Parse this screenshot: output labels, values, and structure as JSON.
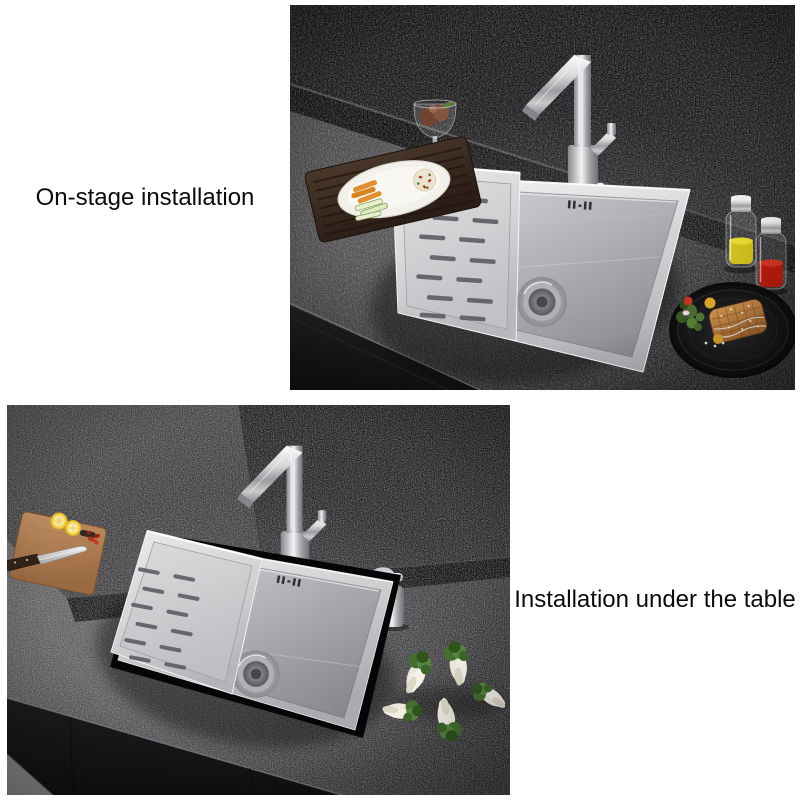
{
  "captions": {
    "top": "On-stage installation",
    "bottom": "Installation under the table"
  },
  "photos": {
    "top_alt": "Stainless steel kitchen sink top-mounted on dark stone countertop",
    "bottom_alt": "Stainless steel kitchen sink under-mounted beneath dark stone countertop"
  },
  "palette": {
    "background": "#ffffff",
    "text": "#0b0b0b",
    "countertop": "#3c3c3e",
    "wall": "#141416",
    "steel": "#d9dadc",
    "oil_yellow": "#d6c51d",
    "oil_red": "#c6180c",
    "wood_dark": "#46342a",
    "wood_light": "#b07a52",
    "lemon": "#f0ce3e",
    "greens": "#456f2e"
  }
}
